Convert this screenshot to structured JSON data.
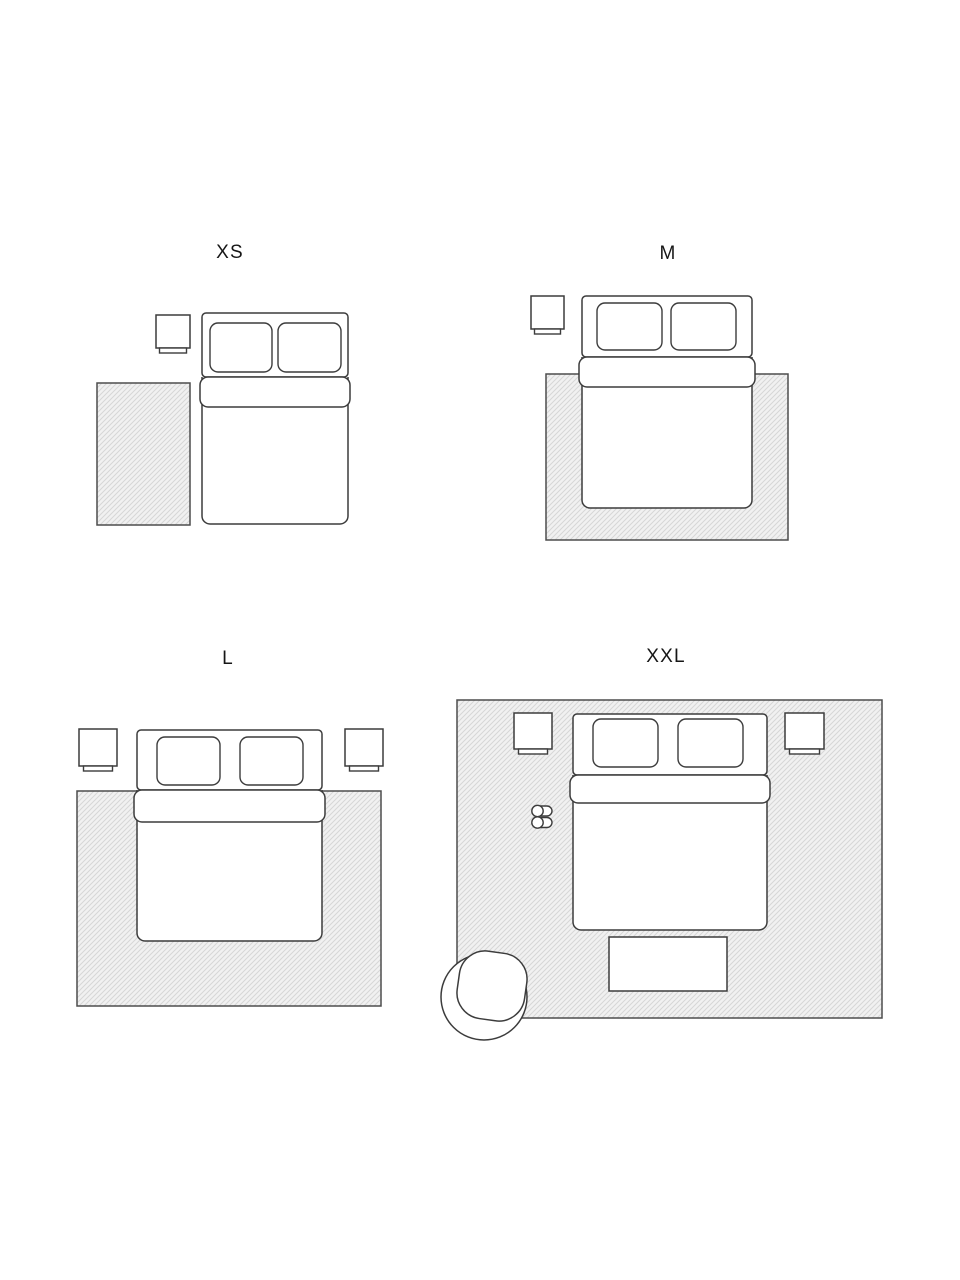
{
  "diagram": {
    "type": "rug-size-guide",
    "background": "#ffffff",
    "colors": {
      "rug_hatch_line": "#d6d6d6",
      "rug_fill": "#f1f1f1",
      "rug_border": "#4d4d4d",
      "furniture_outline": "#3c3c3c",
      "furniture_fill": "#ffffff",
      "label_text": "#161616"
    },
    "panels": [
      {
        "id": "xs",
        "label": "XS",
        "elements": [
          "rug-icon",
          "double-bed-icon",
          "pillow-icon",
          "pillow-icon",
          "nightstand-icon"
        ]
      },
      {
        "id": "m",
        "label": "M",
        "elements": [
          "rug-icon",
          "double-bed-icon",
          "pillow-icon",
          "pillow-icon",
          "nightstand-icon"
        ]
      },
      {
        "id": "l",
        "label": "L",
        "elements": [
          "rug-icon",
          "double-bed-icon",
          "pillow-icon",
          "pillow-icon",
          "nightstand-icon",
          "nightstand-icon"
        ]
      },
      {
        "id": "xxl",
        "label": "XXL",
        "elements": [
          "rug-icon",
          "double-bed-icon",
          "pillow-icon",
          "pillow-icon",
          "nightstand-icon",
          "nightstand-icon",
          "slippers-icon",
          "bench-icon",
          "armchair-icon"
        ]
      }
    ]
  }
}
